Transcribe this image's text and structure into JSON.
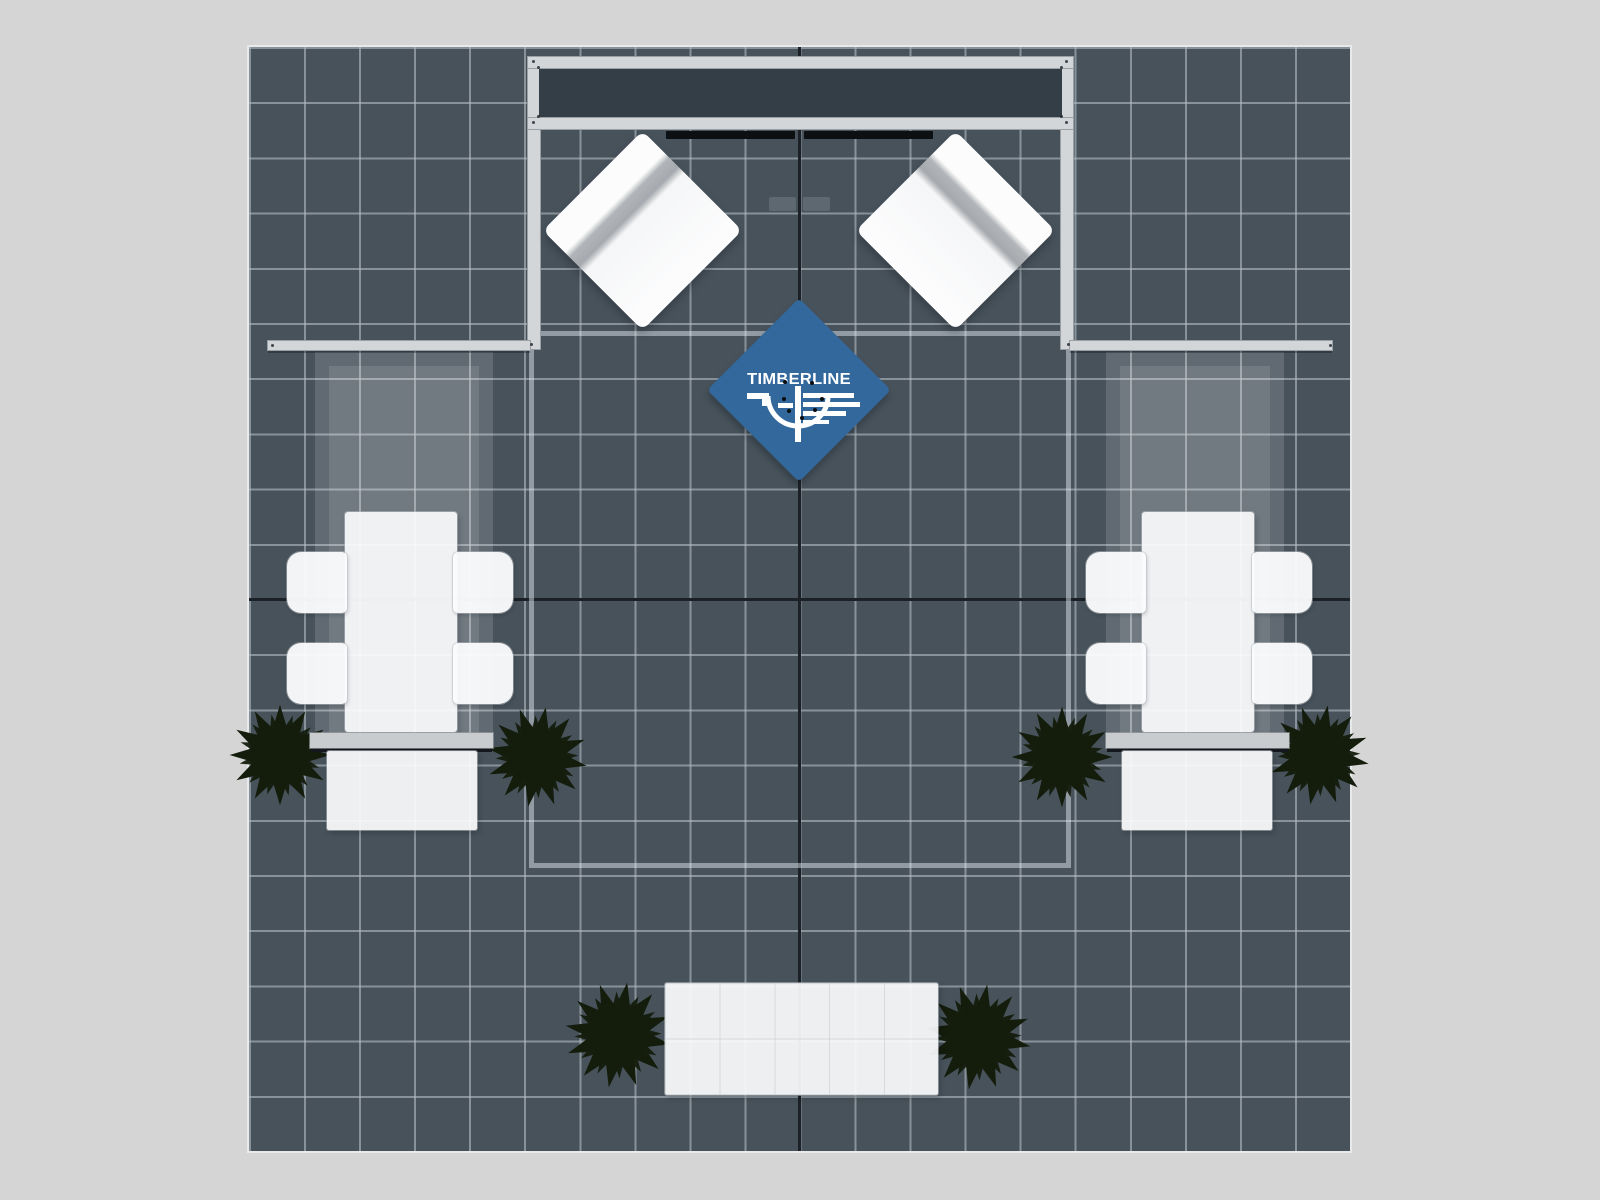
{
  "logo": {
    "text": "TIMBERLINE"
  },
  "colors": {
    "background": "#d5d5d5",
    "floor": "#47525b",
    "grid_line": "#b2bac0",
    "seam": "#1b2126",
    "metal": "#d3d6d8",
    "header_panel": "#343e46",
    "furniture_white": "#fafbfc",
    "stripe_gray": "#a6aaae",
    "accent_blue": "#33689d",
    "plant_dark": "#141c0c",
    "plant_light": "#55683a",
    "logo_white": "#ffffff"
  },
  "scene": {
    "view": "top-down booth floor plan",
    "floor_grid": "20 x 20 tiles",
    "header_frame": 1,
    "white_diamond_canopies": 2,
    "blue_logo_diamond": 1,
    "meeting_tables": 2,
    "chairs": 8,
    "side_counters": 2,
    "reception_counter": 1,
    "planters": 6
  }
}
